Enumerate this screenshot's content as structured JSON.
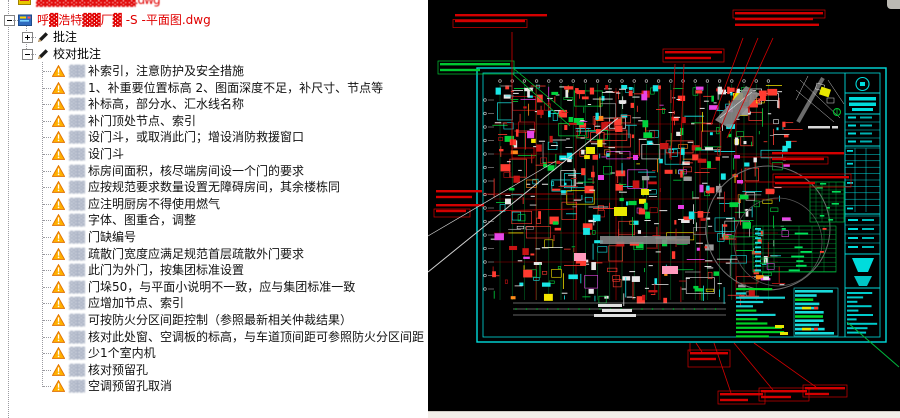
{
  "tree": {
    "clipped_top_node": {
      "label": "▓▓▓▓▓▓▓▓▓▓▓▓.dwg"
    },
    "file_node": {
      "label": "呼▓浩特▓▓厂▓ -S -平面图.dwg"
    },
    "branch_annotations": {
      "label": "批注"
    },
    "branch_review": {
      "label": "校对批注"
    },
    "comment_author_redacted": "▓▓",
    "comments": [
      "补索引，注意防护及安全措施",
      "1、补重要位置标高 2、图面深度不足，补尺寸、节点等",
      "补标高，部分水、汇水线名称",
      "补门顶处节点、索引",
      "设门斗，或取消此门；增设消防救援窗口",
      "设门斗",
      "标房间面积，核尽端房间设一个门的要求",
      "应按规范要求数量设置无障碍房间，其余楼栋同",
      "应注明厨房不得使用燃气",
      "字体、图重合，调整",
      "门缺编号",
      "疏散门宽度应满足规范首层疏散外门要求",
      "此门为外门，按集团标准设置",
      "门垛50，与平面小说明不一致，应与集团标准一致",
      "应增加节点、索引",
      "可按防火分区间距控制（参照最新相关仲裁结果）",
      "核对此处窗、空调板的标高，与车道顶间距可参照防火分区间距",
      "少1个室内机",
      "核对预留孔",
      "空调预留孔取消"
    ]
  },
  "cad": {
    "site_plan_caption_redacted": "▓▓▓▓▓",
    "colors": {
      "background": "#000000",
      "frame_cyan": "#00dcdc",
      "annotation_red": "#d40000",
      "annotation_green": "#00c832",
      "grid_green": "#00a03c",
      "highlight_yellow": "#e8e800",
      "magenta": "#e63ce6",
      "white_line": "#d2d2d2"
    }
  }
}
